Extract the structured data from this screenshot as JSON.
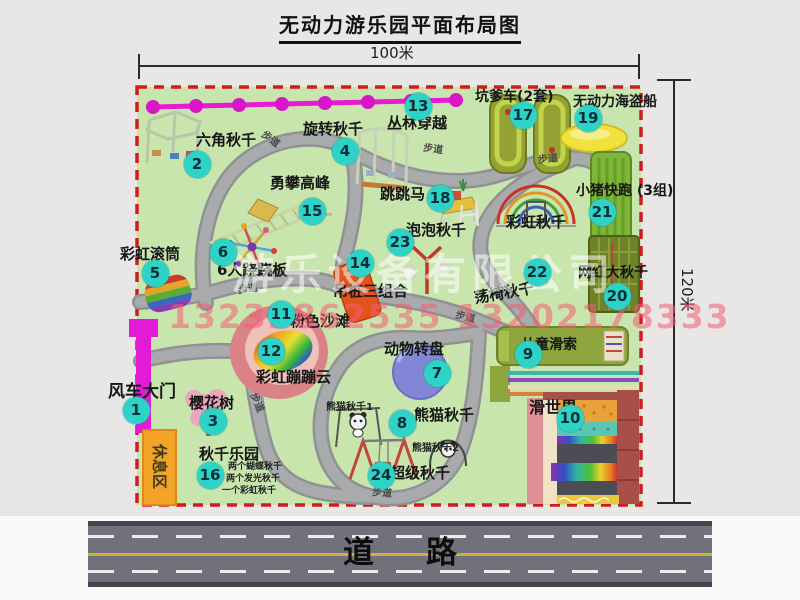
{
  "title": "无动力游乐园平面布局图",
  "dimensions": {
    "top": "100米",
    "right": "120米"
  },
  "road": {
    "label": "道路"
  },
  "rest_area": {
    "label": "休息区"
  },
  "walkway_label": "步道",
  "watermark": {
    "company": "游乐设备有限公司",
    "phone": "13233862535 13202178333"
  },
  "map": {
    "border_color": "#cf1d1d",
    "ground_color": "#c9e5ae",
    "marker_color": "#2ed3c8"
  },
  "attractions": [
    {
      "n": "1",
      "name": "风车大门",
      "circle": [
        136,
        410
      ],
      "label": [
        108,
        384
      ],
      "size": 17
    },
    {
      "n": "2",
      "name": "六角秋千",
      "circle": [
        197,
        164
      ],
      "label": [
        196,
        133
      ],
      "size": 15
    },
    {
      "n": "3",
      "name": "樱花树",
      "circle": [
        213,
        421
      ],
      "label": [
        189,
        396
      ],
      "size": 15
    },
    {
      "n": "4",
      "name": "旋转秋千",
      "circle": [
        345,
        151
      ],
      "label": [
        303,
        122
      ],
      "size": 15
    },
    {
      "n": "5",
      "name": "彩虹滚筒",
      "circle": [
        155,
        273
      ],
      "label": [
        120,
        247
      ],
      "size": 15
    },
    {
      "n": "6",
      "name": "6人跷跷板",
      "circle": [
        223,
        252
      ],
      "label": [
        217,
        263
      ],
      "size": 15
    },
    {
      "n": "7",
      "name": "动物转盘",
      "circle": [
        437,
        373
      ],
      "label": [
        384,
        342
      ],
      "size": 15
    },
    {
      "n": "8",
      "name": "熊猫秋千",
      "circle": [
        402,
        423
      ],
      "label": [
        414,
        408
      ],
      "size": 15
    },
    {
      "n": "9",
      "name": "儿童滑索",
      "circle": [
        528,
        354
      ],
      "label": [
        521,
        338
      ],
      "size": 14
    },
    {
      "n": "10",
      "name": "滑世界",
      "circle": [
        570,
        418
      ],
      "label": [
        529,
        400
      ],
      "size": 16
    },
    {
      "n": "11",
      "name": "粉色沙滩",
      "circle": [
        281,
        314
      ],
      "label": [
        290,
        314
      ],
      "size": 15
    },
    {
      "n": "12",
      "name": "彩虹蹦蹦云",
      "circle": [
        271,
        351
      ],
      "label": [
        256,
        370
      ],
      "size": 15
    },
    {
      "n": "13",
      "name": "丛林穿越",
      "circle": [
        418,
        106
      ],
      "label": [
        387,
        116
      ],
      "size": 15
    },
    {
      "n": "14",
      "name": "吊桩三组合",
      "circle": [
        360,
        263
      ],
      "label": [
        333,
        284
      ],
      "size": 15
    },
    {
      "n": "15",
      "name": "勇攀高峰",
      "circle": [
        312,
        211
      ],
      "label": [
        270,
        176
      ],
      "size": 15
    },
    {
      "n": "16",
      "name": "秋千乐园",
      "circle": [
        210,
        475
      ],
      "label": [
        199,
        447
      ],
      "size": 15
    },
    {
      "n": "17",
      "name": "坑爹车(2套)",
      "circle": [
        523,
        115
      ],
      "label": [
        475,
        90
      ],
      "size": 14
    },
    {
      "n": "18",
      "name": "跳跳马",
      "circle": [
        440,
        198
      ],
      "label": [
        380,
        187
      ],
      "size": 15
    },
    {
      "n": "19",
      "name": "无动力海盗船",
      "circle": [
        588,
        118
      ],
      "label": [
        573,
        95
      ],
      "size": 14
    },
    {
      "n": "20",
      "name": "网红大秋千",
      "circle": [
        617,
        296
      ],
      "label": [
        578,
        266
      ],
      "size": 14
    },
    {
      "n": "21",
      "name": "小猪快跑 (3组)",
      "circle": [
        602,
        212
      ],
      "label": [
        576,
        184
      ],
      "size": 14
    },
    {
      "n": "22",
      "name": "荡椅秋千",
      "circle": [
        537,
        272
      ],
      "label": [
        474,
        286
      ],
      "size": 15,
      "rotate": -10
    },
    {
      "n": "23",
      "name": "泡泡秋千",
      "circle": [
        400,
        242
      ],
      "label": [
        406,
        223
      ],
      "size": 15
    },
    {
      "n": "24",
      "name": "超级秋千",
      "circle": [
        381,
        475
      ],
      "label": [
        390,
        466
      ],
      "size": 15
    }
  ],
  "extra_labels": [
    {
      "text": "彩虹秋千",
      "x": 506,
      "y": 215,
      "size": 15
    },
    {
      "text": "熊猫秋千1",
      "x": 326,
      "y": 403,
      "size": 10
    },
    {
      "text": "熊猫秋千2",
      "x": 412,
      "y": 444,
      "size": 10
    },
    {
      "text": "两个蝴蝶秋千",
      "x": 228,
      "y": 463,
      "size": 9
    },
    {
      "text": "两个发光秋千",
      "x": 226,
      "y": 475,
      "size": 9
    },
    {
      "text": "一个彩虹秋千",
      "x": 222,
      "y": 487,
      "size": 9
    }
  ],
  "walkway_positions": [
    {
      "x": 260,
      "y": 135,
      "rotate": 37
    },
    {
      "x": 423,
      "y": 145,
      "rotate": 8
    },
    {
      "x": 538,
      "y": 155,
      "rotate": -6
    },
    {
      "x": 238,
      "y": 285,
      "rotate": -8
    },
    {
      "x": 246,
      "y": 398,
      "rotate": 66
    },
    {
      "x": 455,
      "y": 313,
      "rotate": 14
    },
    {
      "x": 372,
      "y": 489,
      "rotate": 4
    }
  ]
}
